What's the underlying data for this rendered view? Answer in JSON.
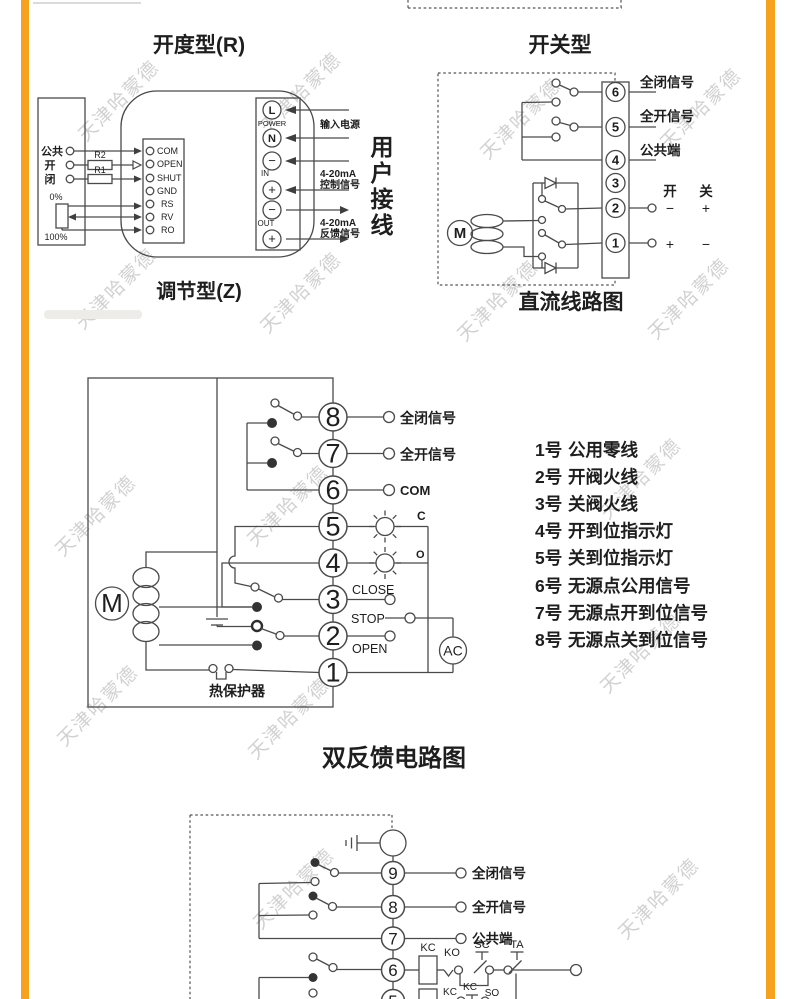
{
  "watermark": {
    "text": "天津哈蒙德"
  },
  "colors": {
    "accent": "#F6A21F",
    "line": "#4a4a4a"
  },
  "d1": {
    "title": "开度型(R)",
    "subtitle": "调节型(Z)",
    "left": {
      "common": "公共",
      "open": "开",
      "close": "闭",
      "r2": "R2",
      "r1": "R1",
      "p0": "0%",
      "p100": "100%"
    },
    "module": [
      "COM",
      "OPEN",
      "SHUT",
      "GND",
      "RS",
      "RV",
      "RO"
    ],
    "power": {
      "l": "L",
      "power_lbl": "POWER",
      "n": "N",
      "minus": "−",
      "plus": "+",
      "in_lbl": "IN",
      "out_lbl": "OUT"
    },
    "notes": {
      "input": "输入电源",
      "ma": "4-20mA",
      "ctrl": "控制信号",
      "fb": "反馈信号"
    },
    "user": [
      "用",
      "户",
      "接",
      "线"
    ]
  },
  "d2": {
    "title": "开关型",
    "caption": "直流线路图",
    "motor": "M",
    "terms": [
      "6",
      "5",
      "4",
      "3",
      "2",
      "1"
    ],
    "closed": "全闭信号",
    "opened": "全开信号",
    "common": "公共端",
    "open_ch": "开",
    "close_ch": "关",
    "plus": "+",
    "minus": "−"
  },
  "d3": {
    "caption": "双反馈电路图",
    "motor": "M",
    "ac": "AC",
    "thermal": "热保护器",
    "terms": [
      "8",
      "7",
      "6",
      "5",
      "4",
      "3",
      "2",
      "1"
    ],
    "closed": "全闭信号",
    "opened": "全开信号",
    "com": "COM",
    "lamp_c": "C",
    "lamp_o": "O",
    "close": "CLOSE",
    "stop": "STOP",
    "open": "OPEN",
    "legend": [
      {
        "num": "1号",
        "text": "公用零线"
      },
      {
        "num": "2号",
        "text": "开阀火线"
      },
      {
        "num": "3号",
        "text": "关阀火线"
      },
      {
        "num": "4号",
        "text": "开到位指示灯"
      },
      {
        "num": "5号",
        "text": "关到位指示灯"
      },
      {
        "num": "6号",
        "text": "无源点公用信号"
      },
      {
        "num": "7号",
        "text": "无源点开到位信号"
      },
      {
        "num": "8号",
        "text": "无源点关到位信号"
      }
    ]
  },
  "d4": {
    "terms": [
      "9",
      "8",
      "7",
      "6",
      "5"
    ],
    "closed": "全闭信号",
    "opened": "全开信号",
    "common": "公共端",
    "kc": "KC",
    "ko": "KO",
    "sc": "SC",
    "ta": "TA",
    "so": "SO"
  }
}
